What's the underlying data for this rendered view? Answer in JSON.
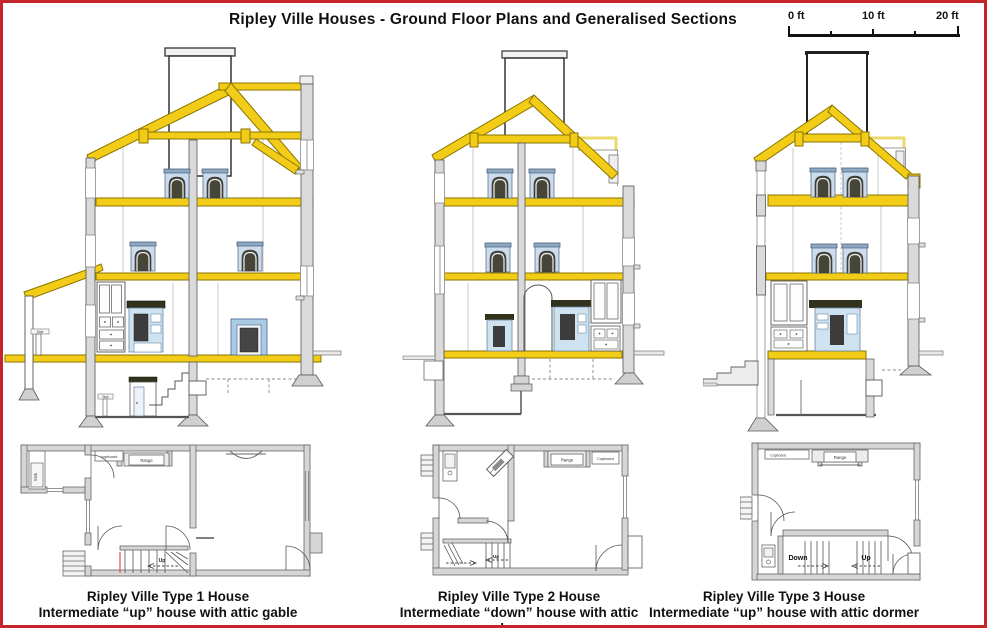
{
  "page": {
    "title": "Ripley Ville Houses - Ground Floor Plans and Generalised Sections"
  },
  "scale_bar": {
    "labels": [
      "0 ft",
      "10 ft",
      "20 ft"
    ]
  },
  "colors": {
    "border_red": "#c5262c",
    "beam_yellow": "#f2cc17",
    "pale_yellow": "#ebd96a",
    "wall_gray": "#dadada",
    "window_blue": "#ccdcec",
    "lintel_dark": "#32321c"
  },
  "houses": [
    {
      "type": "Ripley Ville Type 1 House",
      "subtitle": "Intermediate “up” house with attic gable",
      "section": {
        "sink_label": "Sink",
        "cellar_sink_label": "Sink"
      },
      "plan": {
        "cupboard": "cupboard",
        "range": "Range",
        "up": "Up",
        "sink": "Sink"
      }
    },
    {
      "type": "Ripley Ville Type 2 House",
      "subtitle": "Intermediate “down” house with attic dormer",
      "plan": {
        "range": "Range",
        "cupboard": "Cupboard",
        "up": "Up"
      }
    },
    {
      "type": "Ripley Ville Type 3 House",
      "subtitle": "Intermediate “up” house with attic dormer",
      "plan": {
        "cupboard": "Cupboard",
        "range": "Range",
        "down": "Down",
        "up": "Up"
      }
    }
  ]
}
